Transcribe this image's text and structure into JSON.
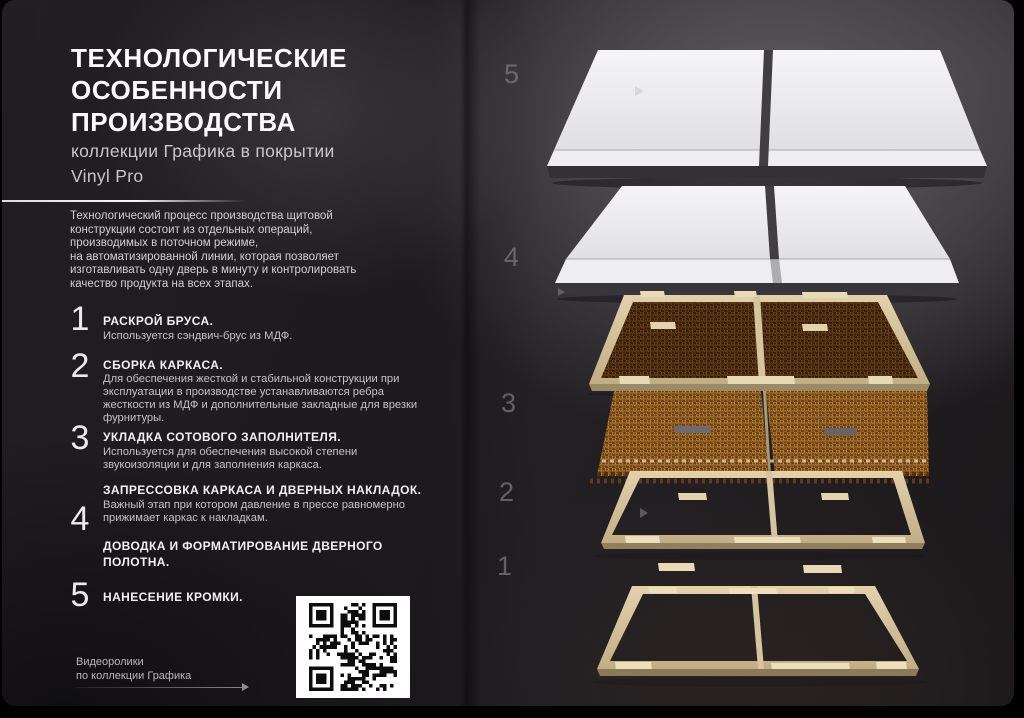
{
  "slide": {
    "title": "ТЕХНОЛОГИЧЕСКИЕ\nОСОБЕННОСТИ\nПРОИЗВОДСТВА",
    "subtitle": "коллекции Графика в покрытии\nVinyl Pro",
    "intro": "Технологический процесс производства щитовой\nконструкции состоит из отдельных операций,\nпроизводимых в поточном режиме,\nна автоматизированной линии, которая позволяет\nизготавливать одну дверь в минуту и контролировать\nкачество продукта на всех этапах.",
    "steps": [
      {
        "num": "1",
        "title": "РАСКРОЙ БРУСА.",
        "desc": "Используется сэндвич-брус из МДФ."
      },
      {
        "num": "2",
        "title": "СБОРКА КАРКАСА.",
        "desc": "Для обеспечения жесткой и стабильной конструкции при\nэксплуатации в производстве устанавливаются ребра\nжесткости из МДФ и дополнительные закладные для врезки\nфурнитуры."
      },
      {
        "num": "3",
        "title": "УКЛАДКА СОТОВОГО ЗАПОЛНИТЕЛЯ.",
        "desc": "Используется для обеспечения высокой степени\nзвукоизоляции и для заполнения каркаса."
      },
      {
        "num": "4",
        "title": "ЗАПРЕССОВКА КАРКАСА И ДВЕРНЫХ НАКЛАДОК.",
        "desc": "Важный этап при котором давление в прессе равномерно\nприжимает каркас к накладкам.",
        "title2": "ДОВОДКА И ФОРМАТИРОВАНИЕ ДВЕРНОГО\nПОЛОТНА."
      },
      {
        "num": "5",
        "title": "НАНЕСЕНИЕ КРОМКИ.",
        "desc": ""
      }
    ],
    "footer": {
      "caption": "Видеоролики\nпо коллекции Графика"
    },
    "qr": {
      "icon": "qr-code"
    },
    "diagram": {
      "layer_numbers": [
        "5",
        "4",
        "3",
        "2",
        "1"
      ],
      "layers": [
        "дверная накладка",
        "дверная накладка",
        "каркас с сотовым заполнителем",
        "сотовый заполнитель",
        "каркас",
        "каркас"
      ]
    },
    "colors": {
      "background": "#242124",
      "panel_white": "#f0f0f2",
      "frame_tan": "#d5c49e",
      "honeycomb_dark": "#35200c",
      "honeycomb_light": "#6e4217",
      "text_primary": "#f2f0f4",
      "text_secondary": "#c5c3c8"
    }
  }
}
